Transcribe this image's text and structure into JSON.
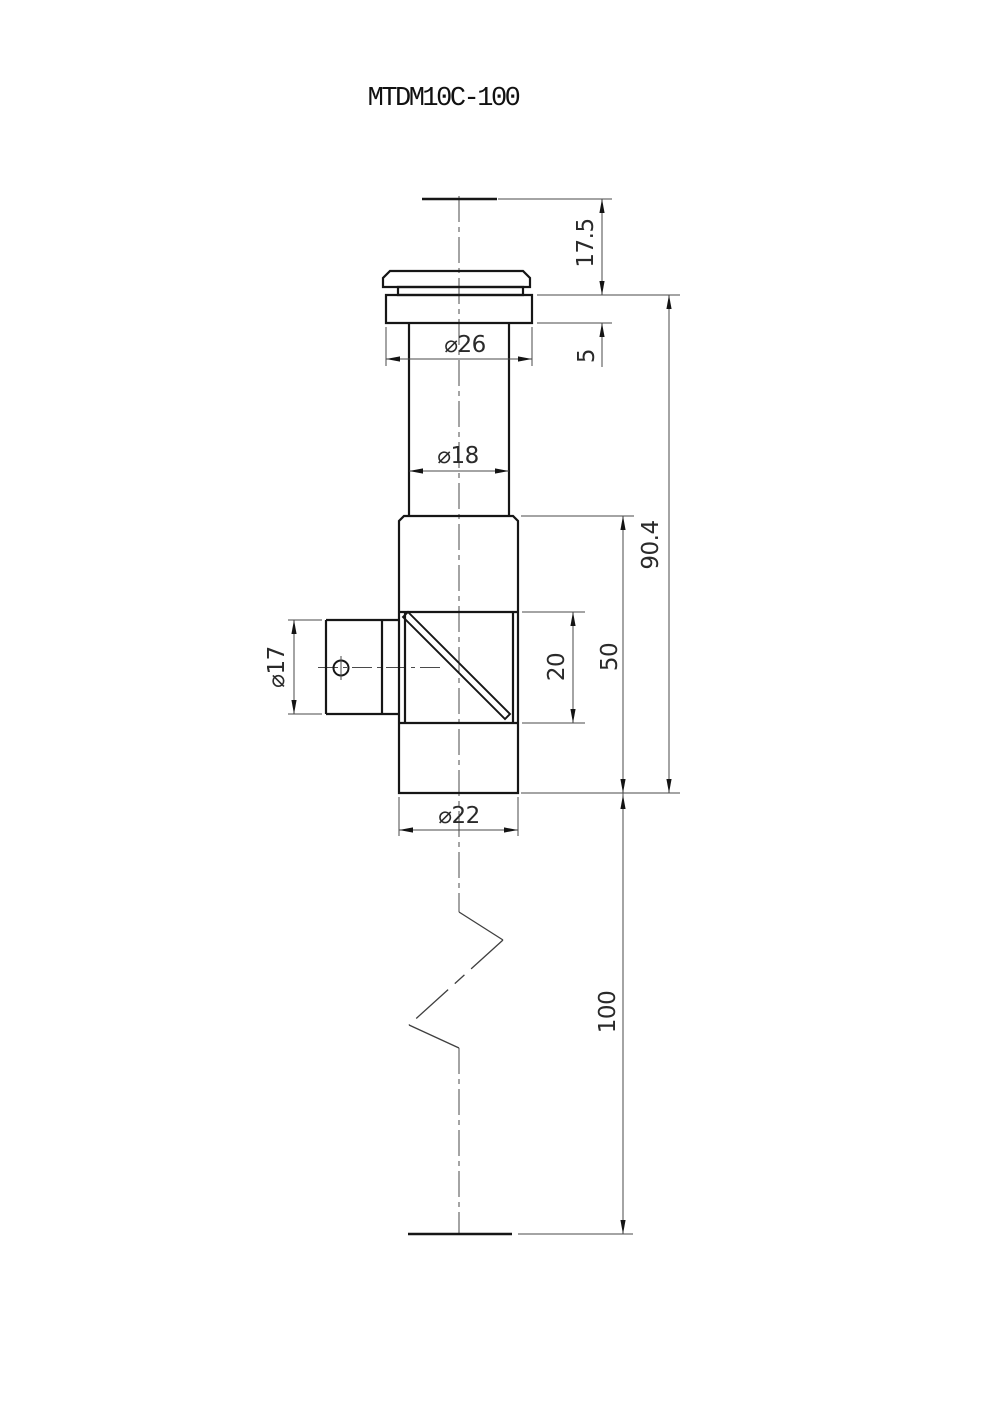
{
  "drawing": {
    "part_number": "MTDM10C-100",
    "dims": {
      "top_clearance": "17.5",
      "flange_thickness": "5",
      "flange_dia": "⌀26",
      "shaft_dia": "⌀18",
      "assembly_height": "90.4",
      "body_height": "50",
      "window_height": "20",
      "port_dia": "⌀17",
      "body_dia": "⌀22",
      "post_length": "100"
    }
  }
}
